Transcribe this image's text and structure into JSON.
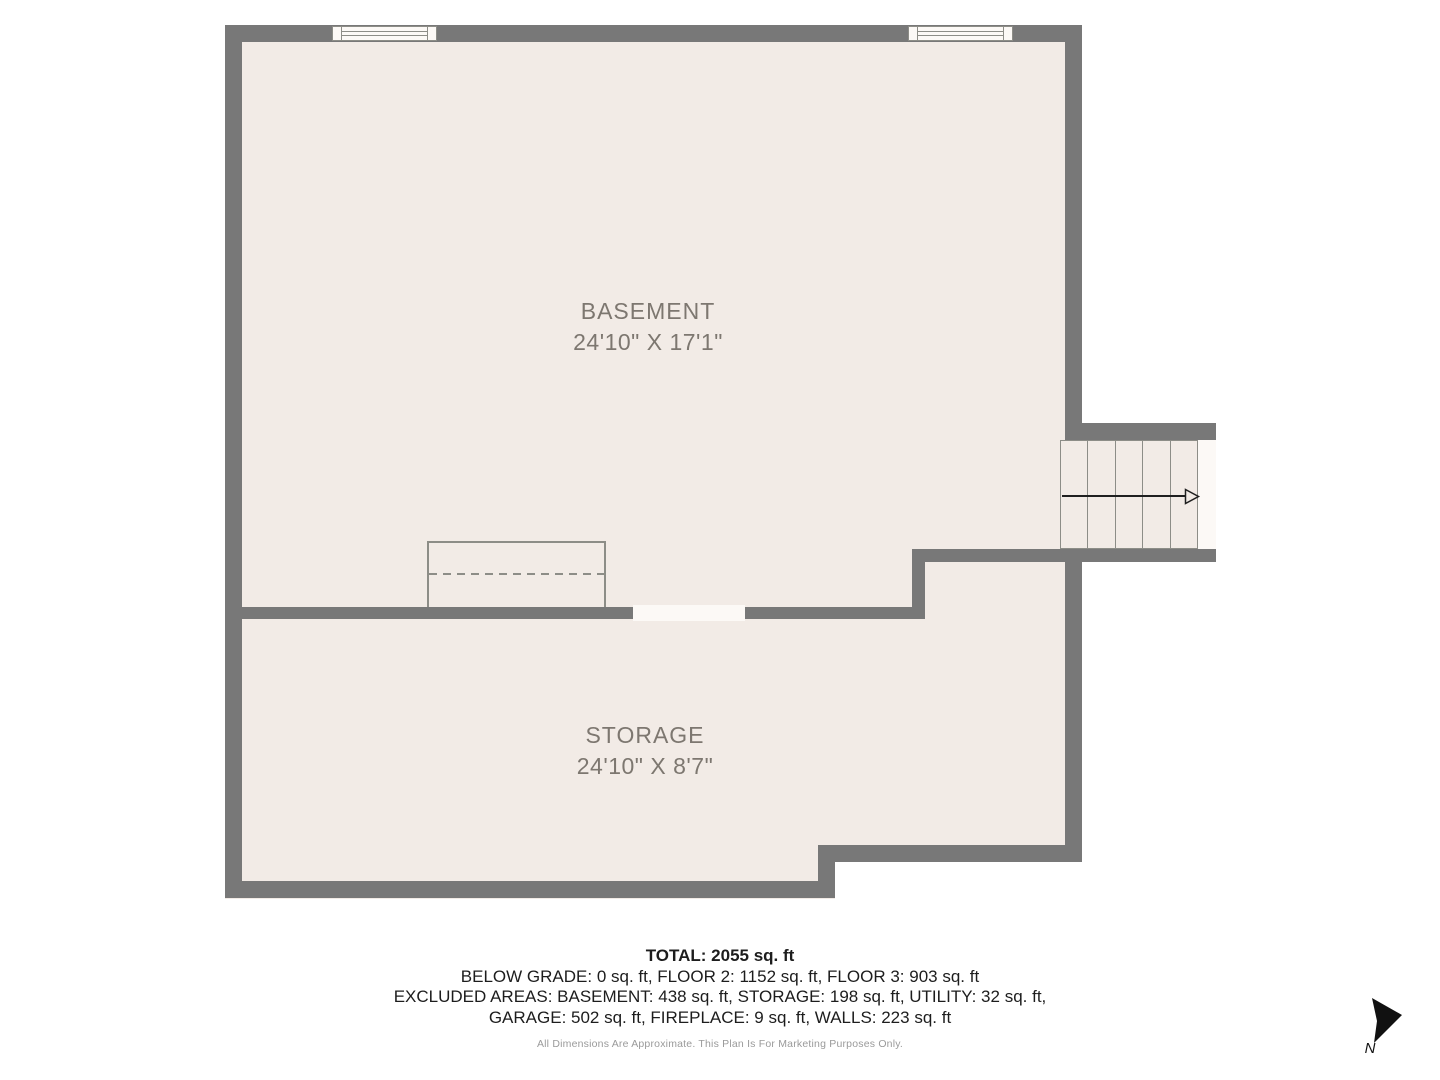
{
  "colors": {
    "wall": "#787878",
    "floor": "#f2ebe6",
    "opening": "#fcf9f6",
    "line": "#8d8d87",
    "label_text": "#7d7770",
    "summary_text": "#1d1d1d",
    "disclaimer_text": "#9a9a9a",
    "arrow": "#1f1f1f"
  },
  "rooms": [
    {
      "name": "BASEMENT",
      "dimensions": "24'10\" X 17'1\""
    },
    {
      "name": "STORAGE",
      "dimensions": "24'10\" X 8'7\""
    }
  ],
  "stairs": {
    "treads": 5,
    "direction": "right"
  },
  "summary": {
    "total": "TOTAL: 2055 sq. ft",
    "lines": [
      "BELOW GRADE: 0 sq. ft, FLOOR 2: 1152 sq. ft, FLOOR 3: 903 sq. ft",
      "EXCLUDED AREAS: BASEMENT: 438 sq. ft, STORAGE: 198 sq. ft, UTILITY: 32 sq. ft,",
      "GARAGE: 502 sq. ft, FIREPLACE: 9 sq. ft, WALLS: 223 sq. ft"
    ],
    "disclaimer": "All Dimensions Are Approximate. This Plan Is For Marketing Purposes Only."
  },
  "compass": {
    "label": "N"
  }
}
